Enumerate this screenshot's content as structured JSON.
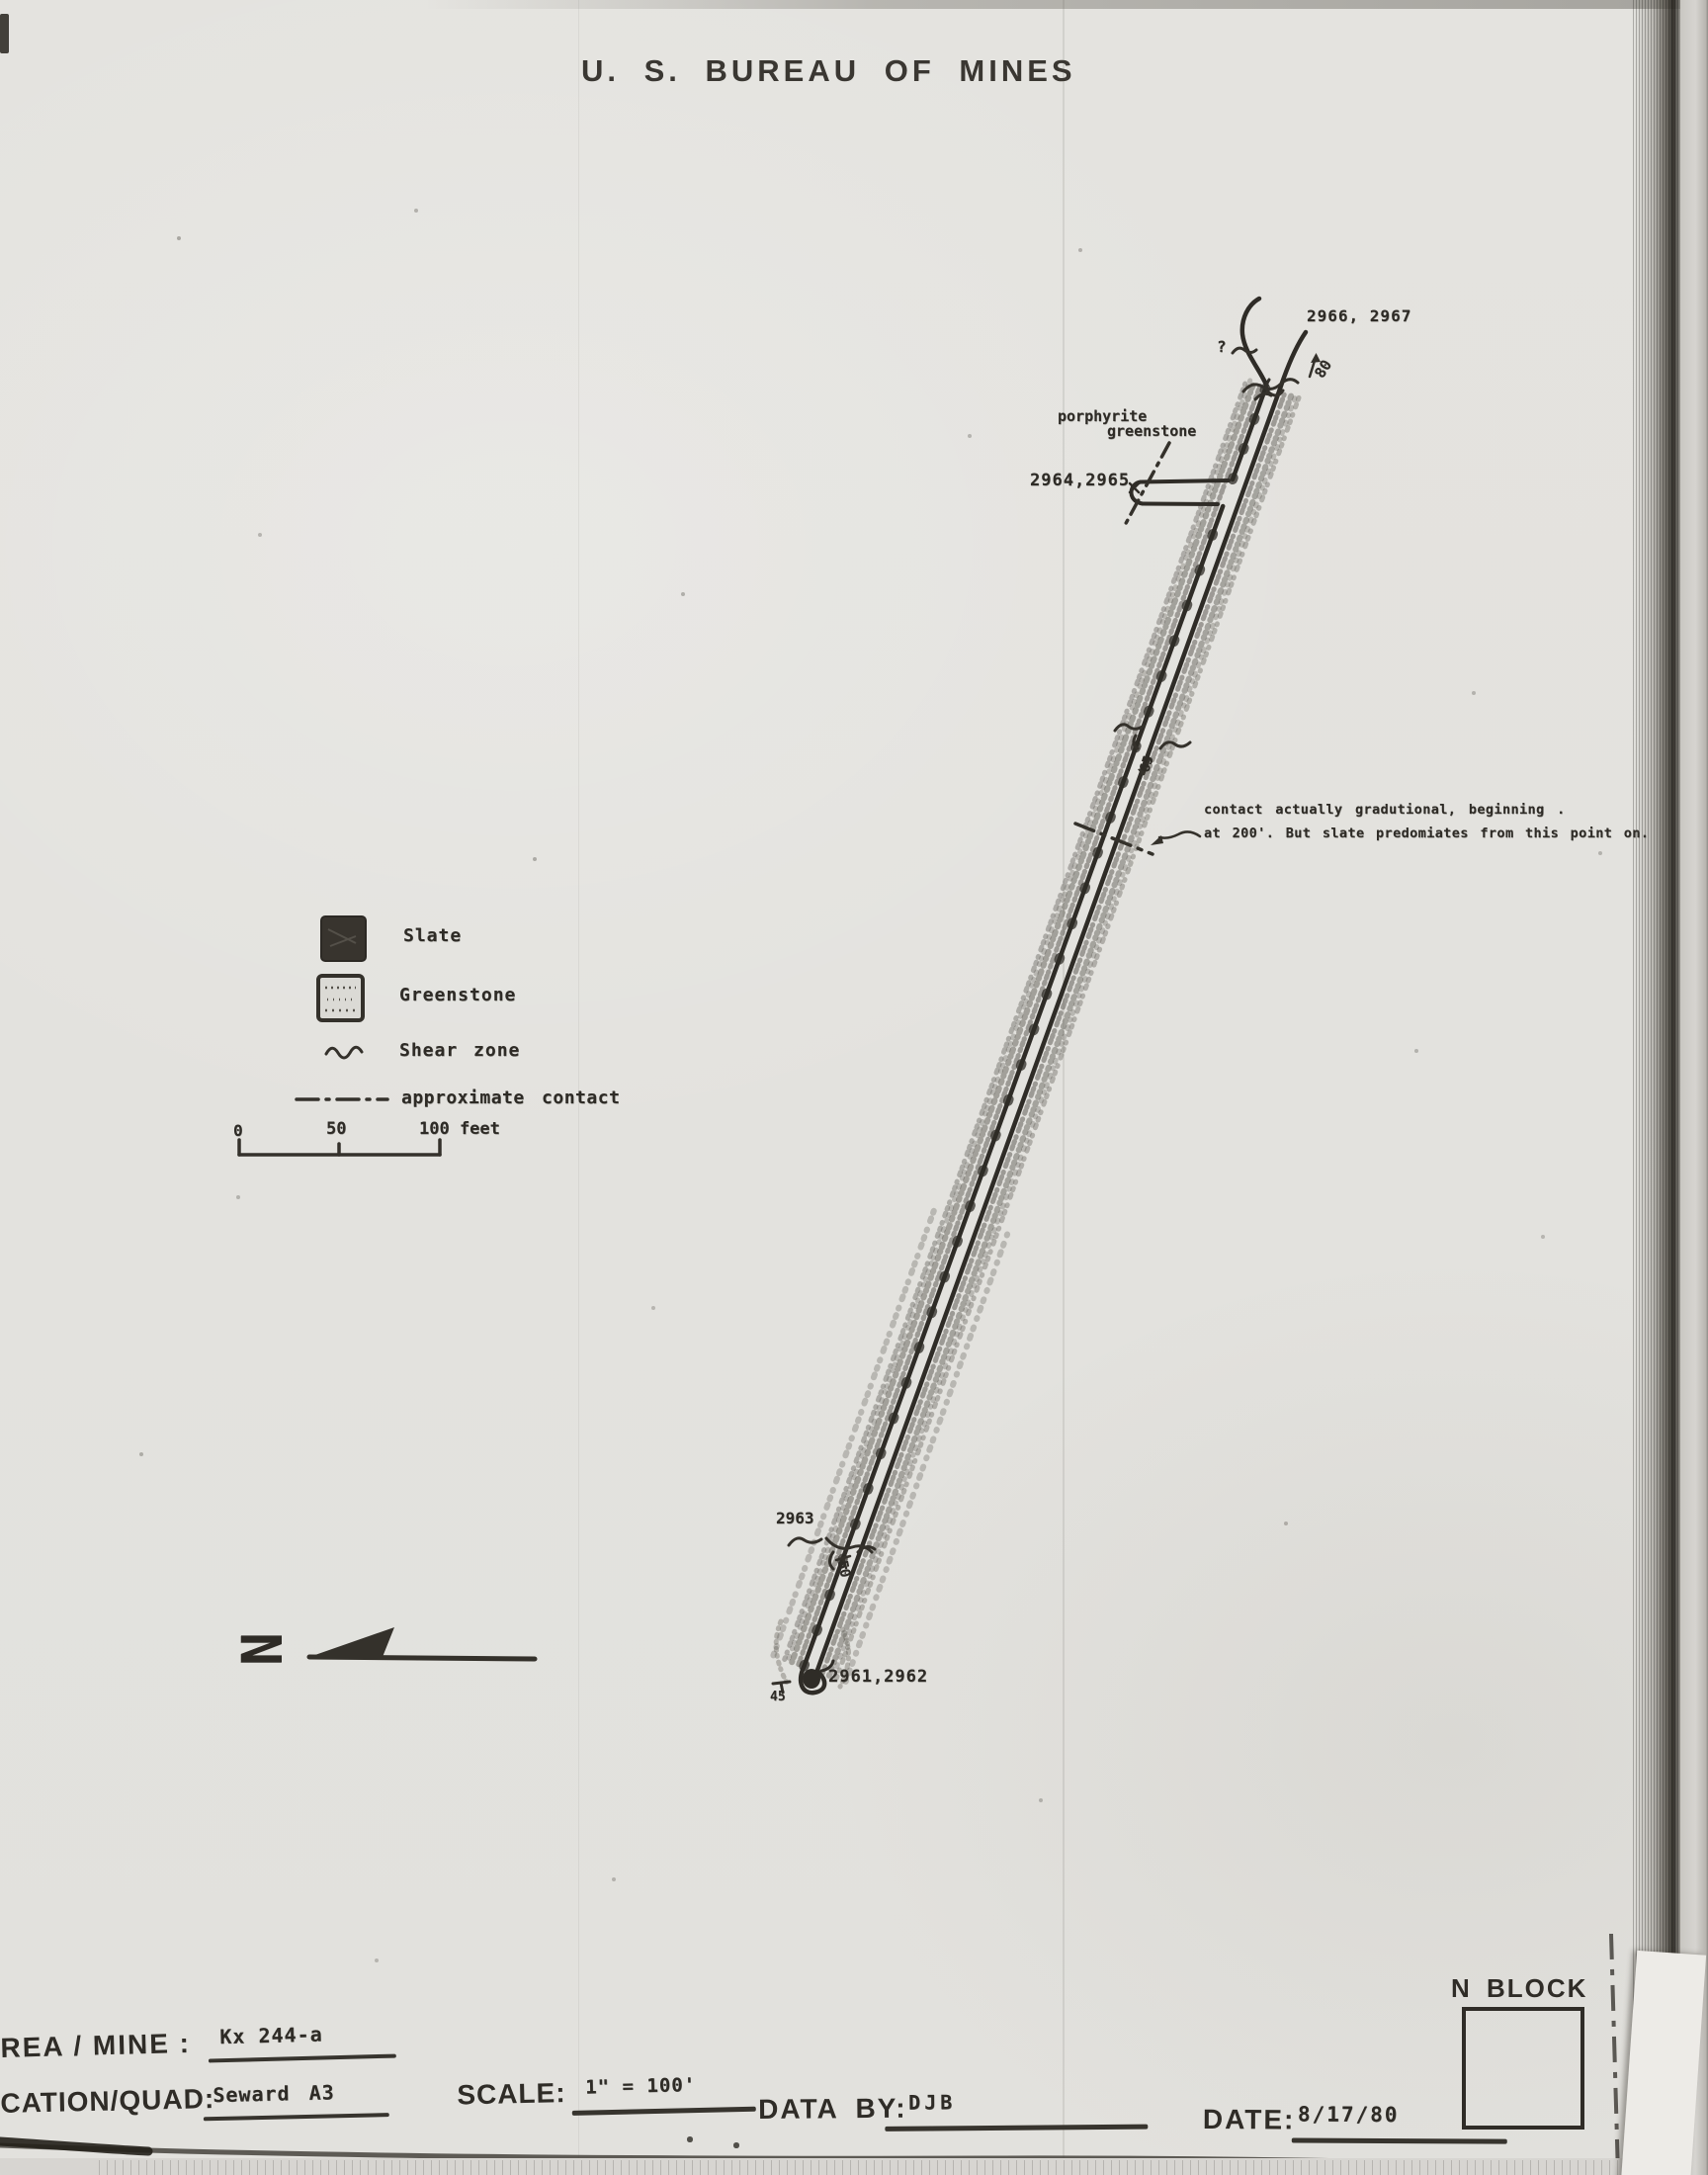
{
  "page": {
    "title": "U. S. BUREAU OF MINES"
  },
  "map": {
    "samples": {
      "top": "2966, 2967",
      "crosscut": "2964,2965",
      "lower": "2963",
      "portal": "2961,2962"
    },
    "dips": {
      "top": "80",
      "mid": "65",
      "lower": "50",
      "portal": "45"
    },
    "unit_label": {
      "line1": "porphyrite",
      "line2": "greenstone"
    },
    "note": {
      "line1": "contact actually gradutional, beginning .",
      "line2": "at 200'. But slate predomiates from this point on."
    },
    "query_mark": "?"
  },
  "legend": {
    "slate": "Slate",
    "greenstone": "Greenstone",
    "shear_zone": "Shear zone",
    "approx_contact": "approximate contact",
    "scale_bar": {
      "t0": "0",
      "t50": "50",
      "t100": "100 feet"
    }
  },
  "compass": {
    "letter": "N"
  },
  "footer": {
    "area_mine_label": "REA / MINE :",
    "area_mine_value": "Kx 244-a",
    "quad_label": "CATION/QUAD:",
    "quad_value": "Seward A3",
    "scale_label": "SCALE:",
    "scale_value": "1\" = 100'",
    "databy_label": "DATA BY:",
    "databy_value": "DJB",
    "date_label": "DATE:",
    "date_value": "8/17/80",
    "n_block": "N BLOCK"
  }
}
